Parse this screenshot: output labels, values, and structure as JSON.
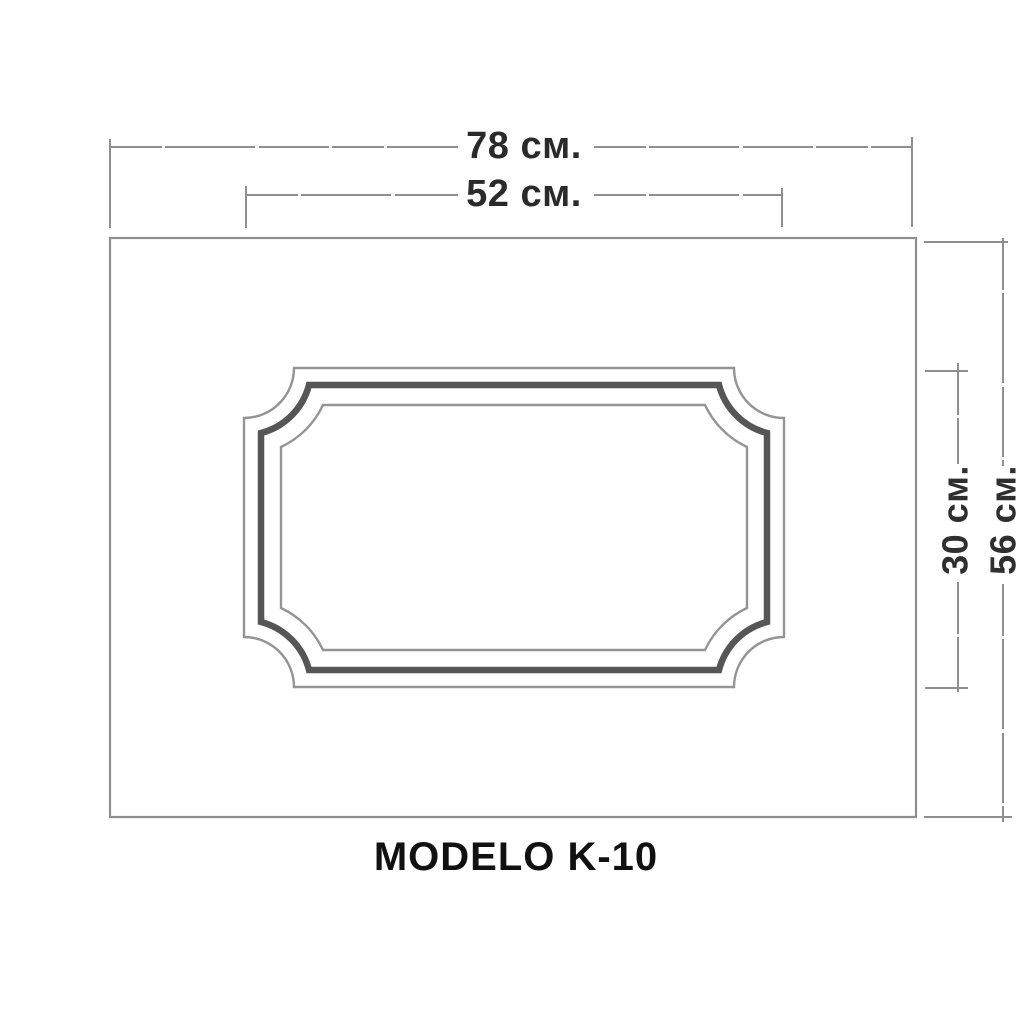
{
  "drawing": {
    "model_label": "MODELO K-10",
    "dims": {
      "outer_width": "78 см.",
      "inner_width": "52 см.",
      "inner_height": "30 см.",
      "outer_height": "56 см."
    },
    "dims_meta": {
      "outer_width": {
        "value": 78,
        "unit": "см"
      },
      "inner_width": {
        "value": 52,
        "unit": "см"
      },
      "inner_height": {
        "value": 30,
        "unit": "см"
      },
      "outer_height": {
        "value": 56,
        "unit": "см"
      }
    }
  },
  "colors": {
    "background": "#ffffff",
    "line_gray": "#8f8f8f",
    "frame_thick_gray": "#565656",
    "dim_text": "#2a2a2a",
    "title_text": "#111111"
  }
}
